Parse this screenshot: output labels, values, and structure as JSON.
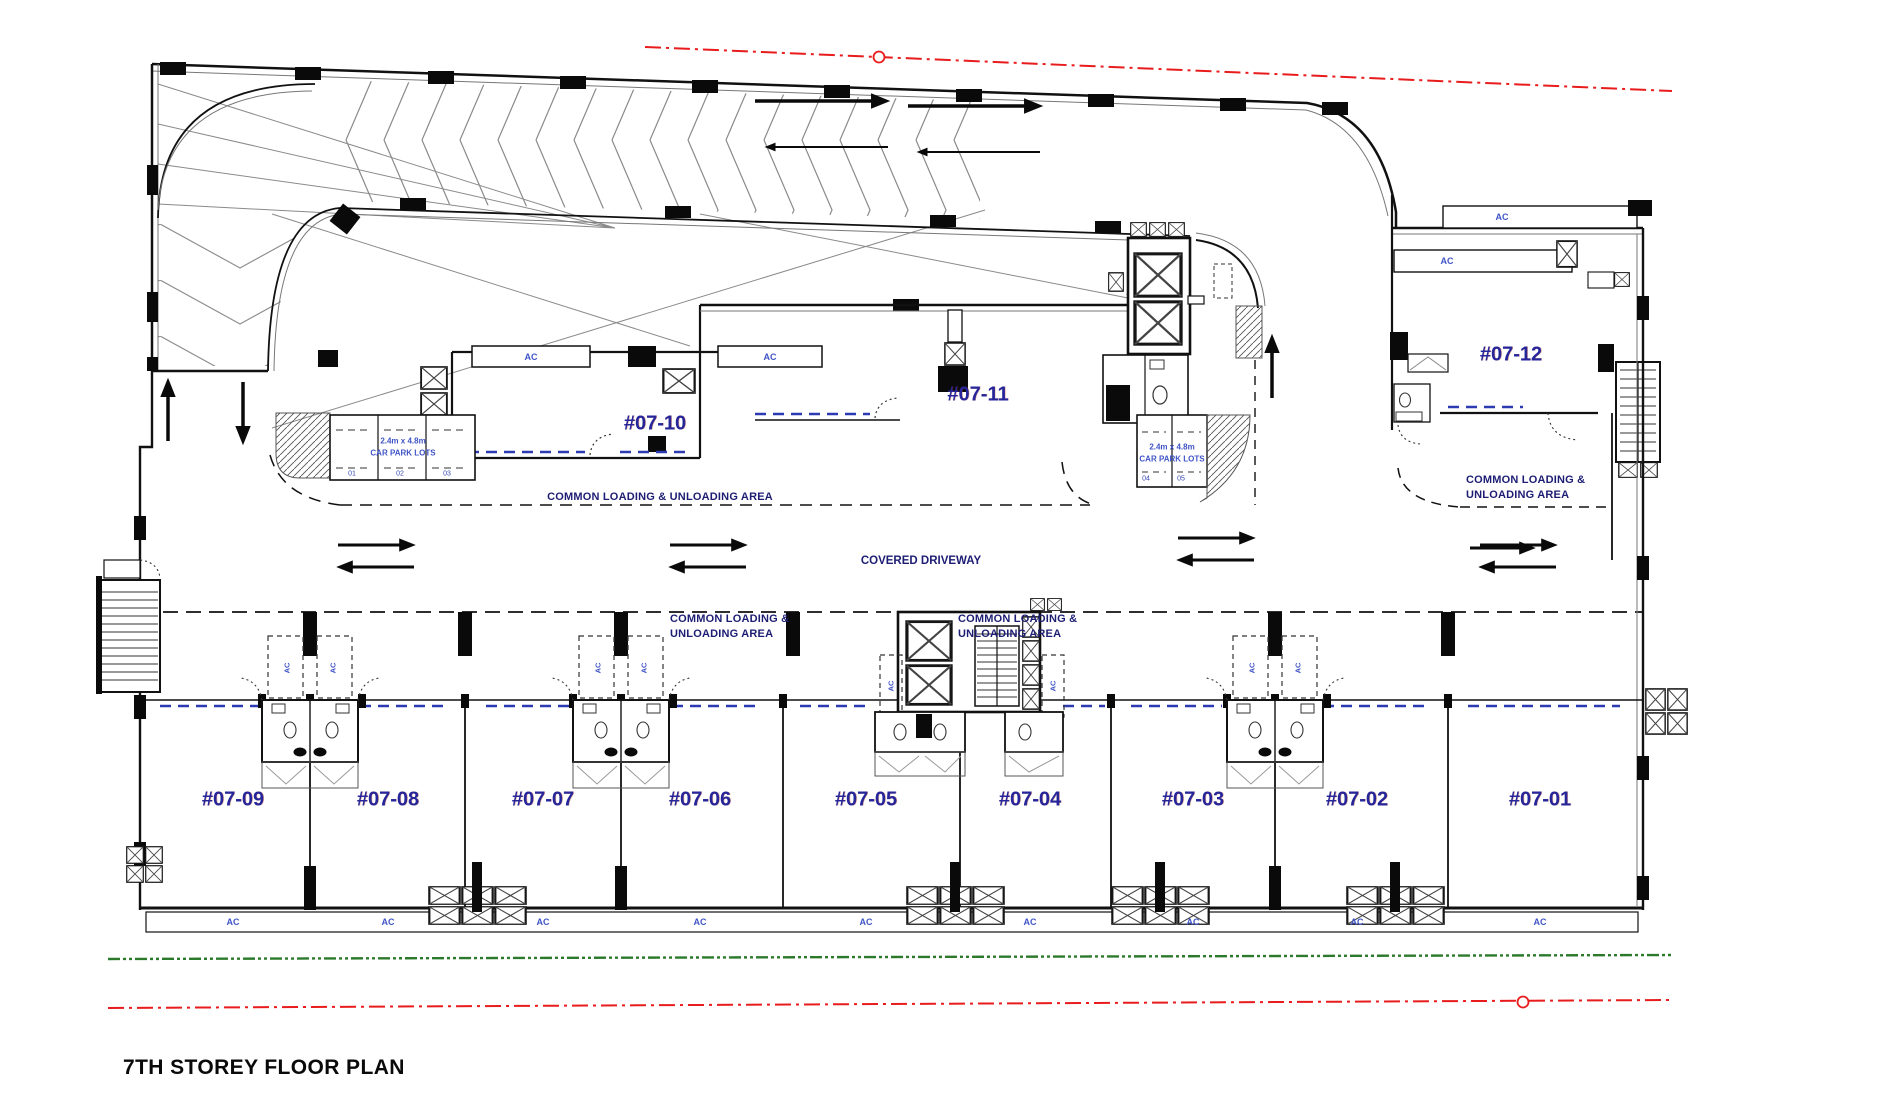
{
  "title": "7TH STOREY FLOOR PLAN",
  "units": {
    "upper": [
      {
        "label": "#07-10"
      },
      {
        "label": "#07-11"
      },
      {
        "label": "#07-12"
      }
    ],
    "lower": [
      {
        "label": "#07-09"
      },
      {
        "label": "#07-08"
      },
      {
        "label": "#07-07"
      },
      {
        "label": "#07-06"
      },
      {
        "label": "#07-05"
      },
      {
        "label": "#07-04"
      },
      {
        "label": "#07-03"
      },
      {
        "label": "#07-02"
      },
      {
        "label": "#07-01"
      }
    ]
  },
  "labels": {
    "covered_driveway": "COVERED DRIVEWAY",
    "common_loading_single": "COMMON LOADING & UNLOADING AREA",
    "common_loading_line1": "COMMON LOADING &",
    "common_loading_line2": "UNLOADING AREA",
    "ac": "AC"
  },
  "carpark": {
    "size": "2.4m x 4.8m",
    "name": "CAR PARK LOTS",
    "lots": [
      "01",
      "02",
      "03",
      "04",
      "05"
    ]
  },
  "colors": {
    "boundary_red": "#e81c1c",
    "boundary_green": "#2b7a2b",
    "unit_label_blue": "#26269a",
    "ac_blue": "#3f54c6",
    "wall_black": "#111111"
  }
}
